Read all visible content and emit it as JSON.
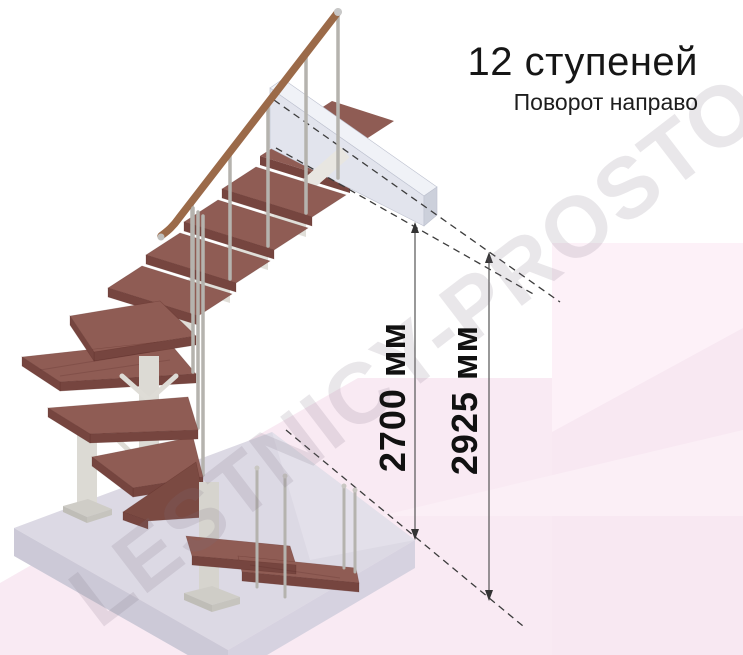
{
  "header": {
    "title": "12 ступеней",
    "subtitle": "Поворот направо"
  },
  "dimensions": {
    "inner": {
      "value": "2700 мм"
    },
    "outer": {
      "value": "2925 мм"
    }
  },
  "watermark": {
    "text": "LESTNICY-PROSTO.RU"
  },
  "colors": {
    "tread_wood": "#8f5c54",
    "tread_front": "#76453f",
    "tread_dark": "#7b4a42",
    "handrail": "#9b6a49",
    "metal": "#b5b3ae",
    "frame_gray": "#dcdad4",
    "floor_slab": "#dcd9e4",
    "floor_slab_edge": "#ccc9d7",
    "upper_slab": "#e2e4ed",
    "background_pink": "#f8e8f2",
    "dashed_line": "#3c3c3c",
    "dimension_line": "#555555",
    "dimension_text": "#111111"
  }
}
